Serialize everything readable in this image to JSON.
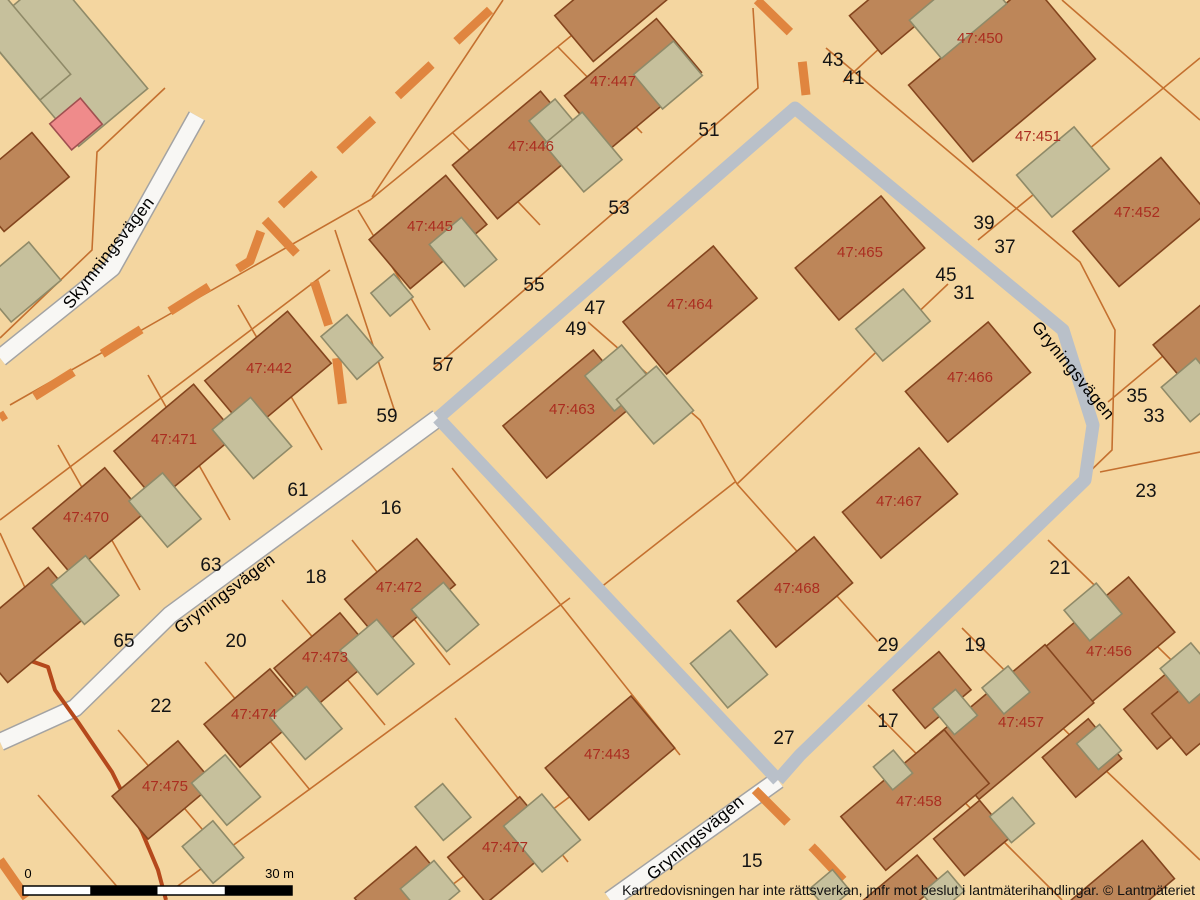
{
  "map": {
    "title": "Cadastral map",
    "disclaimer": "Kartredovisningen har inte rättsverkan, jmfr mot beslut i lantmäterihandlingar. © Lantmäteriet",
    "attribution": "© Lantmäteriet",
    "scale_bar": {
      "label_start": "0",
      "label_end": "30 m",
      "x": 23,
      "y": 886,
      "width": 269,
      "height": 9,
      "segments": 4
    },
    "colors": {
      "background": "#f4d6a0",
      "parcel_line": "#c4702f",
      "building_fill": "#bd8659",
      "building_stroke": "#84451e",
      "outbuilding_fill": "#c6c09c",
      "outbuilding_stroke": "#8f8a68",
      "special_building_fill": "#ef8b8b",
      "special_building_stroke": "#a05050",
      "road_white_fill": "#f8f7f4",
      "road_white_casing": "#a3a3a3",
      "road_gray_fill": "#b9c0c9",
      "dashed_line": "#e0853f",
      "watercourse_line": "#b5491c",
      "property_label": "#ab2d20",
      "house_number": "#141414"
    },
    "street_labels": [
      {
        "text": "Skymningsvägen",
        "x": 113,
        "y": 256,
        "rot": -52
      },
      {
        "text": "Gryningsvägen",
        "x": 228,
        "y": 598,
        "rot": -37
      },
      {
        "text": "Gryningsvägen",
        "x": 1069,
        "y": 374,
        "rot": 51
      },
      {
        "text": "Gryningsvägen",
        "x": 699,
        "y": 842,
        "rot": -40
      }
    ],
    "property_labels": [
      {
        "text": "47:450",
        "x": 980,
        "y": 38
      },
      {
        "text": "47:447",
        "x": 613,
        "y": 81
      },
      {
        "text": "47:451",
        "x": 1038,
        "y": 136
      },
      {
        "text": "47:446",
        "x": 531,
        "y": 146
      },
      {
        "text": "47:452",
        "x": 1137,
        "y": 212
      },
      {
        "text": "47:445",
        "x": 430,
        "y": 226
      },
      {
        "text": "47:465",
        "x": 860,
        "y": 252
      },
      {
        "text": "47:464",
        "x": 690,
        "y": 304
      },
      {
        "text": "47:442",
        "x": 269,
        "y": 368
      },
      {
        "text": "47:466",
        "x": 970,
        "y": 377
      },
      {
        "text": "47:463",
        "x": 572,
        "y": 409
      },
      {
        "text": "47:471",
        "x": 174,
        "y": 439
      },
      {
        "text": "47:467",
        "x": 899,
        "y": 501
      },
      {
        "text": "47:470",
        "x": 86,
        "y": 517
      },
      {
        "text": "47:472",
        "x": 399,
        "y": 587
      },
      {
        "text": "47:468",
        "x": 797,
        "y": 588
      },
      {
        "text": "47:456",
        "x": 1109,
        "y": 651
      },
      {
        "text": "47:473",
        "x": 325,
        "y": 657
      },
      {
        "text": "47:474",
        "x": 254,
        "y": 714
      },
      {
        "text": "47:457",
        "x": 1021,
        "y": 722
      },
      {
        "text": "47:443",
        "x": 607,
        "y": 754
      },
      {
        "text": "47:475",
        "x": 165,
        "y": 786
      },
      {
        "text": "47:458",
        "x": 919,
        "y": 801
      },
      {
        "text": "47:477",
        "x": 505,
        "y": 847
      }
    ],
    "house_numbers": [
      {
        "text": "43",
        "x": 833,
        "y": 59
      },
      {
        "text": "41",
        "x": 854,
        "y": 77
      },
      {
        "text": "51",
        "x": 709,
        "y": 129
      },
      {
        "text": "53",
        "x": 619,
        "y": 207
      },
      {
        "text": "39",
        "x": 984,
        "y": 222
      },
      {
        "text": "37",
        "x": 1005,
        "y": 246
      },
      {
        "text": "45",
        "x": 946,
        "y": 274
      },
      {
        "text": "55",
        "x": 534,
        "y": 284
      },
      {
        "text": "31",
        "x": 964,
        "y": 292
      },
      {
        "text": "47",
        "x": 595,
        "y": 307
      },
      {
        "text": "49",
        "x": 576,
        "y": 328
      },
      {
        "text": "57",
        "x": 443,
        "y": 364
      },
      {
        "text": "35",
        "x": 1137,
        "y": 395
      },
      {
        "text": "59",
        "x": 387,
        "y": 415
      },
      {
        "text": "33",
        "x": 1154,
        "y": 415
      },
      {
        "text": "61",
        "x": 298,
        "y": 489
      },
      {
        "text": "23",
        "x": 1146,
        "y": 490
      },
      {
        "text": "16",
        "x": 391,
        "y": 507
      },
      {
        "text": "63",
        "x": 211,
        "y": 564
      },
      {
        "text": "21",
        "x": 1060,
        "y": 567
      },
      {
        "text": "18",
        "x": 316,
        "y": 576
      },
      {
        "text": "65",
        "x": 124,
        "y": 640
      },
      {
        "text": "20",
        "x": 236,
        "y": 640
      },
      {
        "text": "29",
        "x": 888,
        "y": 644
      },
      {
        "text": "19",
        "x": 975,
        "y": 644
      },
      {
        "text": "22",
        "x": 161,
        "y": 705
      },
      {
        "text": "17",
        "x": 888,
        "y": 720
      },
      {
        "text": "27",
        "x": 784,
        "y": 737
      },
      {
        "text": "15",
        "x": 752,
        "y": 860
      }
    ],
    "roads_white": [
      {
        "name": "Skymningsvägen",
        "w": 16,
        "pts": [
          [
            197,
            116
          ],
          [
            112,
            268
          ],
          [
            0,
            358
          ]
        ]
      },
      {
        "name": "Gryningsvägen",
        "w": 16,
        "pts": [
          [
            438,
            418
          ],
          [
            170,
            615
          ],
          [
            75,
            708
          ],
          [
            0,
            742
          ]
        ]
      },
      {
        "name": "Gryningsvägen",
        "w": 16,
        "pts": [
          [
            778,
            780
          ],
          [
            610,
            900
          ]
        ]
      }
    ],
    "roads_gray": [
      {
        "w": 13,
        "pts": [
          [
            438,
            418
          ],
          [
            795,
            108
          ],
          [
            1063,
            330
          ],
          [
            1093,
            425
          ],
          [
            1085,
            480
          ],
          [
            800,
            755
          ],
          [
            778,
            780
          ]
        ]
      },
      {
        "w": 13,
        "pts": [
          [
            438,
            418
          ],
          [
            778,
            780
          ]
        ]
      }
    ],
    "dashed_lines": [
      [
        [
          490,
          10
        ],
        [
          265,
          220
        ],
        [
          250,
          261
        ],
        [
          0,
          418
        ]
      ],
      [
        [
          265,
          220
        ],
        [
          310,
          268
        ],
        [
          335,
          345
        ],
        [
          345,
          425
        ]
      ],
      [
        [
          757,
          0
        ],
        [
          800,
          42
        ],
        [
          806,
          95
        ]
      ],
      [
        [
          755,
          790
        ],
        [
          815,
          850
        ],
        [
          862,
          900
        ]
      ],
      [
        [
          0,
          860
        ],
        [
          28,
          900
        ]
      ]
    ],
    "watercourse": [
      [
        0,
        650
      ],
      [
        48,
        667
      ],
      [
        55,
        690
      ],
      [
        78,
        722
      ],
      [
        112,
        772
      ],
      [
        142,
        832
      ],
      [
        158,
        870
      ],
      [
        166,
        900
      ]
    ],
    "boundaries": [
      [
        [
          615,
          0
        ],
        [
          370,
          200
        ],
        [
          10,
          405
        ]
      ],
      [
        [
          753,
          8
        ],
        [
          758,
          88
        ],
        [
          434,
          368
        ]
      ],
      [
        [
          503,
          0
        ],
        [
          372,
          197
        ]
      ],
      [
        [
          558,
          47
        ],
        [
          642,
          133
        ]
      ],
      [
        [
          452,
          132
        ],
        [
          540,
          225
        ]
      ],
      [
        [
          358,
          210
        ],
        [
          430,
          330
        ]
      ],
      [
        [
          165,
          88
        ],
        [
          97,
          152
        ],
        [
          92,
          250
        ],
        [
          0,
          338
        ]
      ],
      [
        [
          330,
          270
        ],
        [
          0,
          520
        ]
      ],
      [
        [
          335,
          230
        ],
        [
          395,
          412
        ]
      ],
      [
        [
          238,
          305
        ],
        [
          322,
          450
        ]
      ],
      [
        [
          148,
          375
        ],
        [
          230,
          520
        ]
      ],
      [
        [
          58,
          445
        ],
        [
          140,
          590
        ]
      ],
      [
        [
          0,
          533
        ],
        [
          48,
          638
        ]
      ],
      [
        [
          452,
          468
        ],
        [
          680,
          755
        ]
      ],
      [
        [
          352,
          540
        ],
        [
          450,
          665
        ]
      ],
      [
        [
          282,
          600
        ],
        [
          385,
          725
        ]
      ],
      [
        [
          205,
          662
        ],
        [
          310,
          790
        ]
      ],
      [
        [
          118,
          730
        ],
        [
          230,
          862
        ]
      ],
      [
        [
          38,
          795
        ],
        [
          120,
          890
        ]
      ],
      [
        [
          570,
          598
        ],
        [
          175,
          888
        ]
      ],
      [
        [
          455,
          718
        ],
        [
          568,
          862
        ]
      ],
      [
        [
          648,
          738
        ],
        [
          432,
          900
        ]
      ],
      [
        [
          588,
          322
        ],
        [
          700,
          420
        ],
        [
          737,
          484
        ]
      ],
      [
        [
          948,
          284
        ],
        [
          737,
          484
        ]
      ],
      [
        [
          737,
          484
        ],
        [
          878,
          642
        ]
      ],
      [
        [
          735,
          482
        ],
        [
          600,
          588
        ]
      ],
      [
        [
          843,
          82
        ],
        [
          932,
          0
        ]
      ],
      [
        [
          1062,
          0
        ],
        [
          1200,
          120
        ]
      ],
      [
        [
          978,
          240
        ],
        [
          1200,
          58
        ]
      ],
      [
        [
          1108,
          402
        ],
        [
          1200,
          325
        ]
      ],
      [
        [
          1100,
          472
        ],
        [
          1200,
          452
        ]
      ],
      [
        [
          1048,
          540
        ],
        [
          1200,
          688
        ]
      ],
      [
        [
          826,
          48
        ],
        [
          1080,
          262
        ],
        [
          1115,
          330
        ],
        [
          1112,
          450
        ],
        [
          800,
          752
        ]
      ],
      [
        [
          962,
          628
        ],
        [
          1100,
          765
        ],
        [
          1200,
          860
        ]
      ],
      [
        [
          868,
          705
        ],
        [
          1010,
          848
        ],
        [
          1062,
          900
        ]
      ]
    ],
    "houses": [
      [
        633,
        84,
        120,
        70
      ],
      [
        620,
        0,
        120,
        60
      ],
      [
        900,
        6,
        90,
        50
      ],
      [
        1002,
        72,
        160,
        100
      ],
      [
        1140,
        222,
        115,
        72
      ],
      [
        519,
        155,
        115,
        70
      ],
      [
        428,
        232,
        100,
        64
      ],
      [
        860,
        258,
        112,
        68
      ],
      [
        690,
        310,
        118,
        68
      ],
      [
        268,
        372,
        108,
        68
      ],
      [
        968,
        382,
        108,
        66
      ],
      [
        570,
        414,
        118,
        68
      ],
      [
        175,
        443,
        104,
        66
      ],
      [
        88,
        521,
        94,
        60
      ],
      [
        900,
        503,
        100,
        60
      ],
      [
        795,
        592,
        100,
        60
      ],
      [
        400,
        592,
        94,
        60
      ],
      [
        325,
        662,
        86,
        56
      ],
      [
        255,
        718,
        86,
        56
      ],
      [
        163,
        790,
        86,
        56
      ],
      [
        610,
        758,
        112,
        68
      ],
      [
        503,
        850,
        94,
        60
      ],
      [
        1100,
        648,
        135,
        72
      ],
      [
        1168,
        706,
        72,
        52
      ],
      [
        1012,
        722,
        150,
        76
      ],
      [
        1082,
        758,
        60,
        52
      ],
      [
        932,
        690,
        60,
        50
      ],
      [
        915,
        800,
        135,
        70
      ],
      [
        972,
        838,
        60,
        48
      ],
      [
        18,
        182,
        85,
        58
      ],
      [
        28,
        625,
        105,
        62
      ],
      [
        400,
        890,
        80,
        46
      ],
      [
        900,
        893,
        75,
        36
      ],
      [
        1195,
        345,
        64,
        54
      ],
      [
        1192,
        715,
        60,
        54
      ],
      [
        1122,
        890,
        95,
        50
      ]
    ],
    "outbuildings": [
      [
        668,
        75,
        52,
        45
      ],
      [
        553,
        123,
        34,
        34
      ],
      [
        583,
        152,
        50,
        62
      ],
      [
        463,
        252,
        42,
        55
      ],
      [
        392,
        295,
        30,
        30
      ],
      [
        352,
        347,
        34,
        56
      ],
      [
        1063,
        172,
        75,
        55
      ],
      [
        958,
        12,
        85,
        50
      ],
      [
        893,
        325,
        62,
        42
      ],
      [
        618,
        378,
        48,
        46
      ],
      [
        655,
        405,
        52,
        58
      ],
      [
        252,
        438,
        50,
        64
      ],
      [
        165,
        510,
        44,
        60
      ],
      [
        85,
        590,
        45,
        52
      ],
      [
        20,
        282,
        65,
        50
      ],
      [
        445,
        617,
        42,
        55
      ],
      [
        377,
        657,
        48,
        58
      ],
      [
        306,
        723,
        48,
        55
      ],
      [
        226,
        790,
        44,
        55
      ],
      [
        213,
        852,
        40,
        48
      ],
      [
        729,
        669,
        52,
        58
      ],
      [
        1093,
        612,
        42,
        40
      ],
      [
        1006,
        690,
        34,
        34
      ],
      [
        1190,
        673,
        40,
        45
      ],
      [
        955,
        712,
        30,
        34
      ],
      [
        893,
        770,
        26,
        30
      ],
      [
        1099,
        747,
        30,
        34
      ],
      [
        1012,
        820,
        30,
        34
      ],
      [
        830,
        890,
        30,
        28
      ],
      [
        943,
        892,
        34,
        26
      ],
      [
        542,
        833,
        50,
        60
      ],
      [
        443,
        812,
        36,
        44
      ],
      [
        430,
        890,
        44,
        40
      ],
      [
        1193,
        390,
        45,
        45
      ],
      [
        65,
        60,
        90,
        150
      ],
      [
        20,
        45,
        40,
        110
      ]
    ],
    "special_buildings": [
      [
        76,
        124,
        40,
        34
      ]
    ],
    "building_rotation_deg": -40
  }
}
